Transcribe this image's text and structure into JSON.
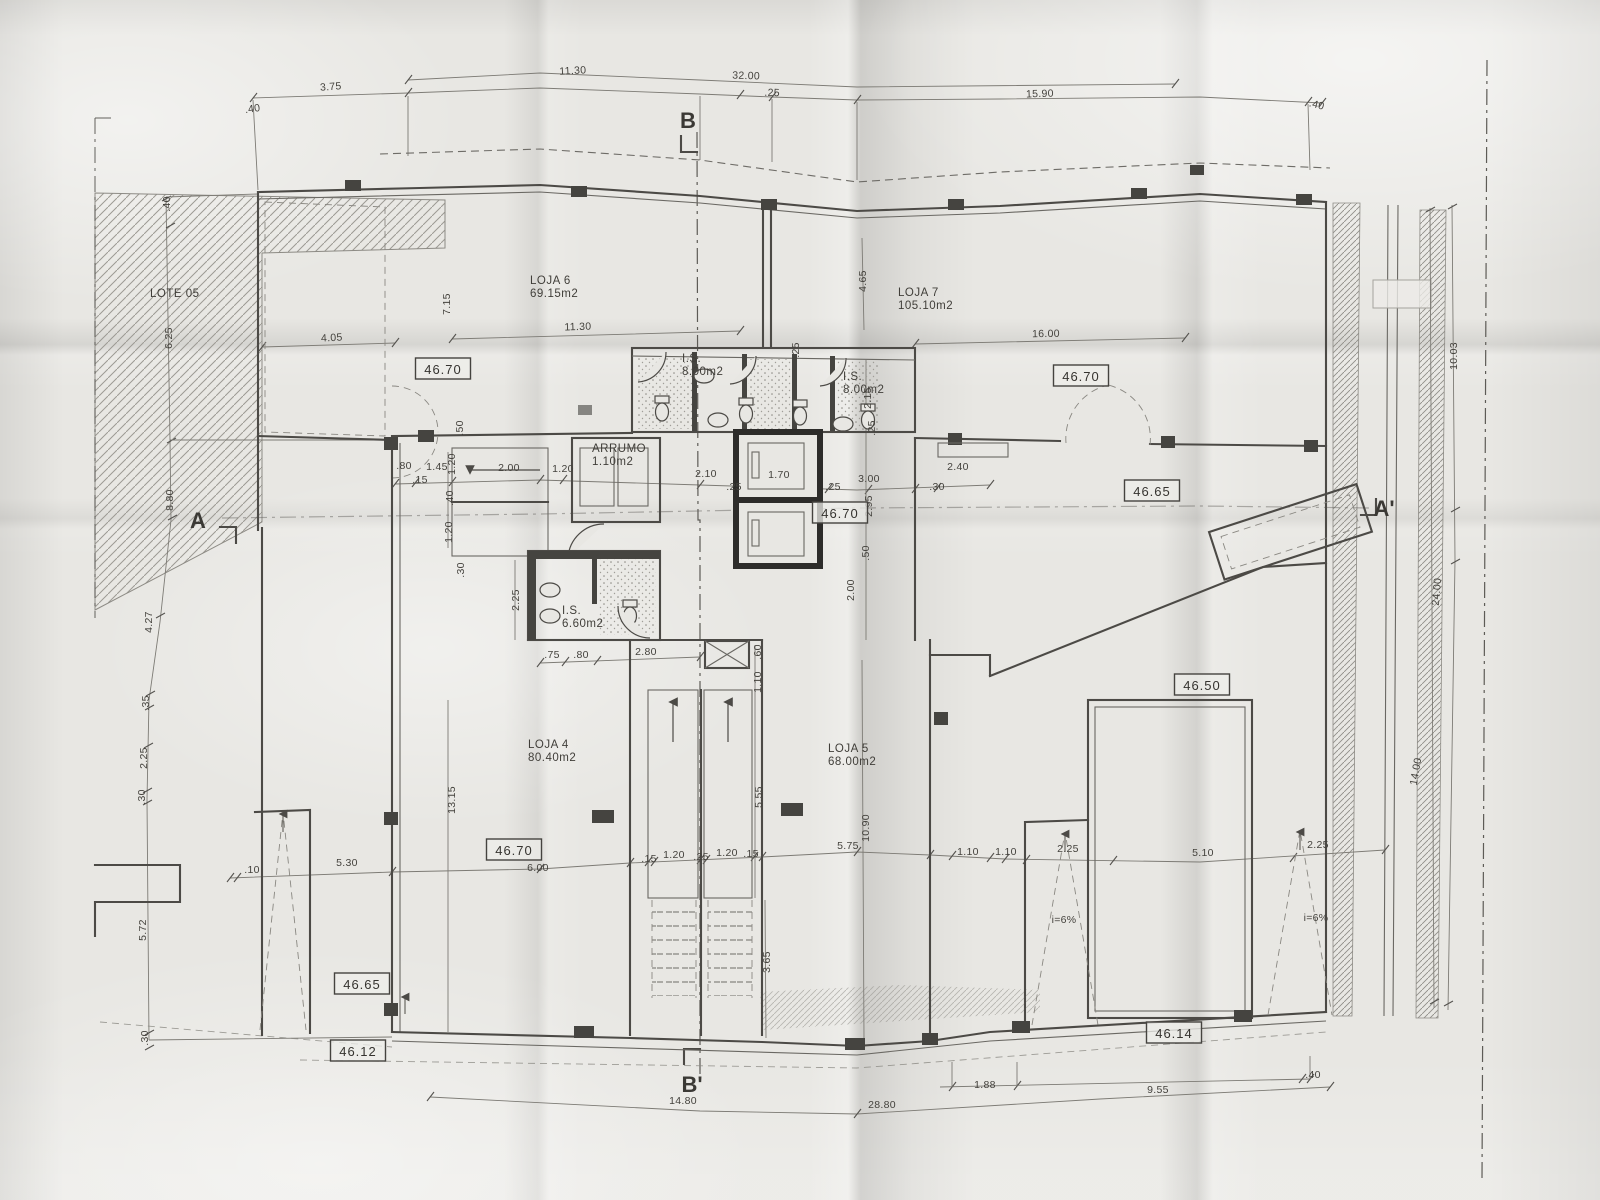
{
  "plan": {
    "section_markers": [
      {
        "text": "B",
        "x": 688,
        "y": 128
      },
      {
        "text": "B'",
        "x": 692,
        "y": 1092
      },
      {
        "text": "A",
        "x": 198,
        "y": 528
      },
      {
        "text": "A'",
        "x": 1384,
        "y": 516
      }
    ],
    "room_labels": [
      {
        "lines": [
          "LOJA 6",
          "69.15m2"
        ],
        "x": 530,
        "y": 284
      },
      {
        "lines": [
          "LOJA 7",
          "105.10m2"
        ],
        "x": 898,
        "y": 296
      },
      {
        "lines": [
          "LOJA 4",
          "80.40m2"
        ],
        "x": 528,
        "y": 748
      },
      {
        "lines": [
          "LOJA 5",
          "68.00m2"
        ],
        "x": 828,
        "y": 752
      },
      {
        "lines": [
          "I.S.",
          "8.00m2"
        ],
        "x": 682,
        "y": 362
      },
      {
        "lines": [
          "I.S.",
          "8.00m2"
        ],
        "x": 843,
        "y": 380
      },
      {
        "lines": [
          "I.S.",
          "6.60m2"
        ],
        "x": 562,
        "y": 614
      },
      {
        "lines": [
          "ARRUMO",
          "1.10m2"
        ],
        "x": 592,
        "y": 452
      },
      {
        "lines": [
          "LOTE 05"
        ],
        "x": 150,
        "y": 297
      }
    ],
    "level_badges": [
      {
        "text": "46.70",
        "x": 443,
        "y": 370
      },
      {
        "text": "46.70",
        "x": 1081,
        "y": 377
      },
      {
        "text": "46.70",
        "x": 840,
        "y": 514
      },
      {
        "text": "46.70",
        "x": 514,
        "y": 851
      },
      {
        "text": "46.65",
        "x": 1152,
        "y": 492
      },
      {
        "text": "46.65",
        "x": 362,
        "y": 985
      },
      {
        "text": "46.50",
        "x": 1202,
        "y": 686
      },
      {
        "text": "46.12",
        "x": 358,
        "y": 1052
      },
      {
        "text": "46.14",
        "x": 1174,
        "y": 1034
      }
    ],
    "dim_labels": [
      {
        "t": ".40",
        "x": 253,
        "y": 112,
        "r": -8
      },
      {
        "t": "3.75",
        "x": 331,
        "y": 90,
        "r": -4
      },
      {
        "t": "11.30",
        "x": 573,
        "y": 74,
        "r": -3
      },
      {
        "t": "32.00",
        "x": 746,
        "y": 79,
        "r": 2
      },
      {
        "t": ".25",
        "x": 772,
        "y": 96,
        "r": 2
      },
      {
        "t": "15.90",
        "x": 1040,
        "y": 97,
        "r": -2
      },
      {
        "t": ".40",
        "x": 1316,
        "y": 108,
        "r": 14
      },
      {
        "t": ".40",
        "x": 170,
        "y": 204,
        "r": -90
      },
      {
        "t": "6.25",
        "x": 172,
        "y": 338,
        "r": -90
      },
      {
        "t": "8.80",
        "x": 173,
        "y": 500,
        "r": -90
      },
      {
        "t": "4.27",
        "x": 152,
        "y": 622,
        "r": -90
      },
      {
        "t": ".35",
        "x": 149,
        "y": 703,
        "r": -90
      },
      {
        "t": "2.25",
        "x": 147,
        "y": 758,
        "r": -90
      },
      {
        "t": ".30",
        "x": 145,
        "y": 797,
        "r": -90
      },
      {
        "t": "5.72",
        "x": 146,
        "y": 930,
        "r": -90
      },
      {
        "t": ".30",
        "x": 148,
        "y": 1038,
        "r": -90
      },
      {
        "t": "4.05",
        "x": 332,
        "y": 341,
        "r": -3
      },
      {
        "t": "7.15",
        "x": 450,
        "y": 304,
        "r": -90
      },
      {
        "t": ".50",
        "x": 463,
        "y": 428,
        "r": -90
      },
      {
        "t": "11.30",
        "x": 578,
        "y": 330,
        "r": -2
      },
      {
        "t": "16.00",
        "x": 1046,
        "y": 337,
        "r": -1
      },
      {
        "t": "4.65",
        "x": 866,
        "y": 281,
        "r": -90
      },
      {
        "t": "2.15",
        "x": 871,
        "y": 398,
        "r": -90
      },
      {
        "t": ".25",
        "x": 875,
        "y": 428,
        "r": -90
      },
      {
        "t": ".25",
        "x": 799,
        "y": 350,
        "r": -90
      },
      {
        "t": ".80",
        "x": 404,
        "y": 469
      },
      {
        "t": "1.45",
        "x": 437,
        "y": 470
      },
      {
        "t": ".15",
        "x": 420,
        "y": 483
      },
      {
        "t": "2.00",
        "x": 509,
        "y": 471
      },
      {
        "t": "1.20",
        "x": 563,
        "y": 472
      },
      {
        "t": "2.10",
        "x": 706,
        "y": 477
      },
      {
        "t": ".25",
        "x": 734,
        "y": 490
      },
      {
        "t": "1.70",
        "x": 779,
        "y": 478
      },
      {
        "t": ".25",
        "x": 833,
        "y": 490
      },
      {
        "t": "3.00",
        "x": 869,
        "y": 482
      },
      {
        "t": ".30",
        "x": 937,
        "y": 490
      },
      {
        "t": "2.40",
        "x": 958,
        "y": 470
      },
      {
        "t": "1.20",
        "x": 455,
        "y": 464,
        "r": -90
      },
      {
        "t": ".40",
        "x": 453,
        "y": 498,
        "r": -90
      },
      {
        "t": "1.20",
        "x": 452,
        "y": 532,
        "r": -90
      },
      {
        "t": ".30",
        "x": 464,
        "y": 570,
        "r": -90
      },
      {
        "t": "2.95",
        "x": 872,
        "y": 506,
        "r": -90
      },
      {
        "t": ".50",
        "x": 869,
        "y": 553,
        "r": -90
      },
      {
        "t": "2.00",
        "x": 854,
        "y": 590,
        "r": -90
      },
      {
        "t": "2.25",
        "x": 519,
        "y": 600,
        "r": -90
      },
      {
        "t": "13.15",
        "x": 455,
        "y": 800,
        "r": -90
      },
      {
        "t": ".75",
        "x": 552,
        "y": 658
      },
      {
        "t": ".80",
        "x": 581,
        "y": 658
      },
      {
        "t": "2.80",
        "x": 646,
        "y": 655
      },
      {
        "t": ".60",
        "x": 761,
        "y": 652,
        "r": -90
      },
      {
        "t": "1.10",
        "x": 761,
        "y": 682,
        "r": -90
      },
      {
        "t": "5.55",
        "x": 762,
        "y": 797,
        "r": -90
      },
      {
        "t": "10.90",
        "x": 869,
        "y": 828,
        "r": -90
      },
      {
        "t": "5.75",
        "x": 848,
        "y": 849
      },
      {
        "t": "6.00",
        "x": 538,
        "y": 871
      },
      {
        "t": "5.30",
        "x": 347,
        "y": 866
      },
      {
        "t": ".10",
        "x": 252,
        "y": 873
      },
      {
        "t": ".15",
        "x": 649,
        "y": 862
      },
      {
        "t": "1.20",
        "x": 674,
        "y": 858
      },
      {
        "t": ".25",
        "x": 701,
        "y": 860
      },
      {
        "t": "1.20",
        "x": 727,
        "y": 856
      },
      {
        "t": ".15",
        "x": 751,
        "y": 857
      },
      {
        "t": "3.65",
        "x": 770,
        "y": 962,
        "r": -90
      },
      {
        "t": "1.10",
        "x": 968,
        "y": 855
      },
      {
        "t": "1.10",
        "x": 1006,
        "y": 855
      },
      {
        "t": "2.25",
        "x": 1068,
        "y": 852
      },
      {
        "t": "5.10",
        "x": 1203,
        "y": 856
      },
      {
        "t": "2.25",
        "x": 1318,
        "y": 848
      },
      {
        "t": "i=6%",
        "x": 1064,
        "y": 923
      },
      {
        "t": "i=6%",
        "x": 1316,
        "y": 921
      },
      {
        "t": "14.80",
        "x": 683,
        "y": 1104
      },
      {
        "t": "28.80",
        "x": 882,
        "y": 1108
      },
      {
        "t": "1.88",
        "x": 985,
        "y": 1088
      },
      {
        "t": "9.55",
        "x": 1158,
        "y": 1093
      },
      {
        "t": ".40",
        "x": 1313,
        "y": 1078
      },
      {
        "t": "10.03",
        "x": 1457,
        "y": 356,
        "r": -90
      },
      {
        "t": "24.00",
        "x": 1440,
        "y": 592,
        "r": -85
      },
      {
        "t": "14.00",
        "x": 1419,
        "y": 772,
        "r": -80
      }
    ]
  }
}
